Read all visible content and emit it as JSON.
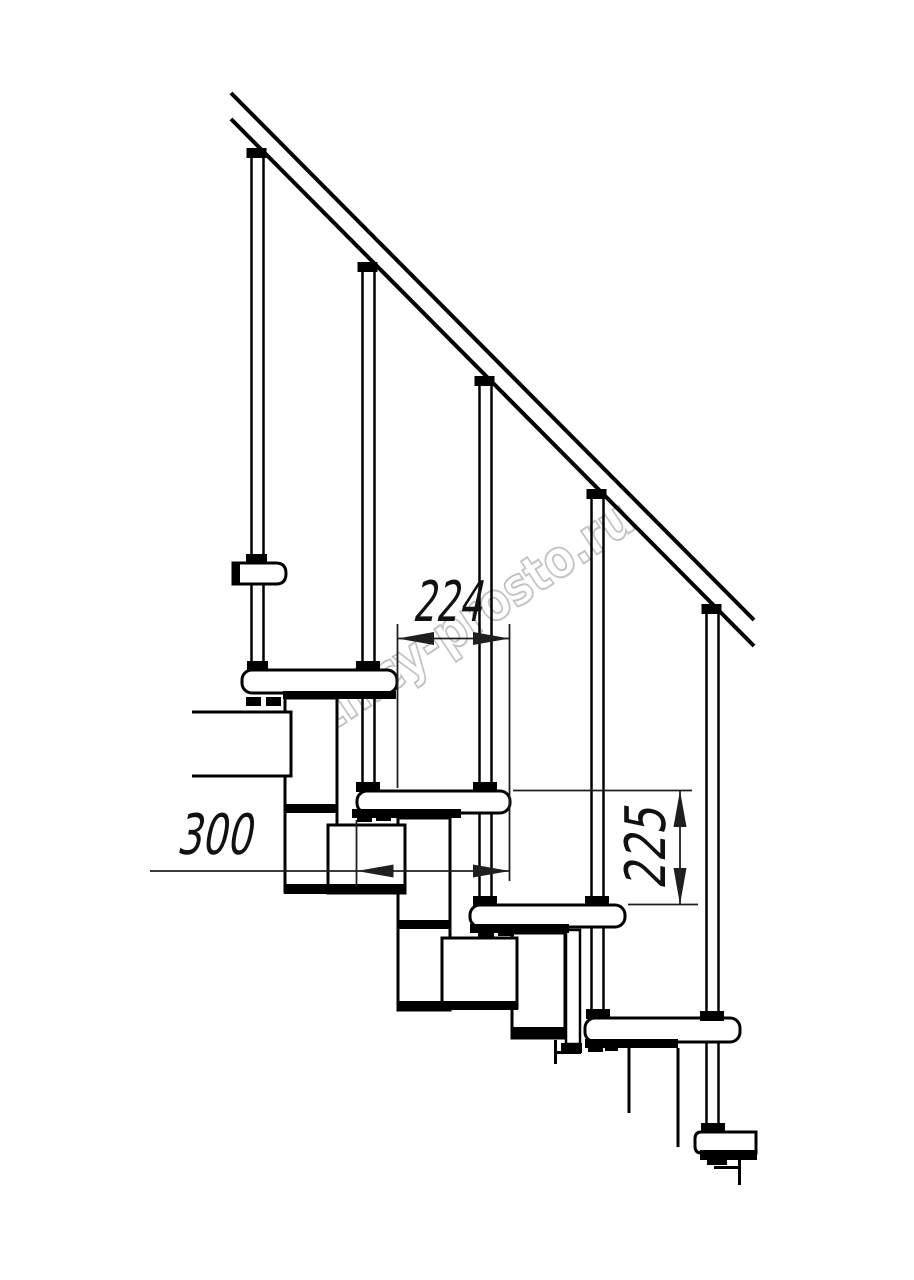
{
  "watermark": {
    "text": "lestnicy-prosto.ru",
    "color": "#c3c3c3"
  },
  "dimensions": {
    "going": {
      "value": "224"
    },
    "depth": {
      "value": "300"
    },
    "rise": {
      "value": "225"
    }
  },
  "palette": {
    "line": "#000000",
    "dimension": "#1f1f1f",
    "background": "#ffffff"
  }
}
